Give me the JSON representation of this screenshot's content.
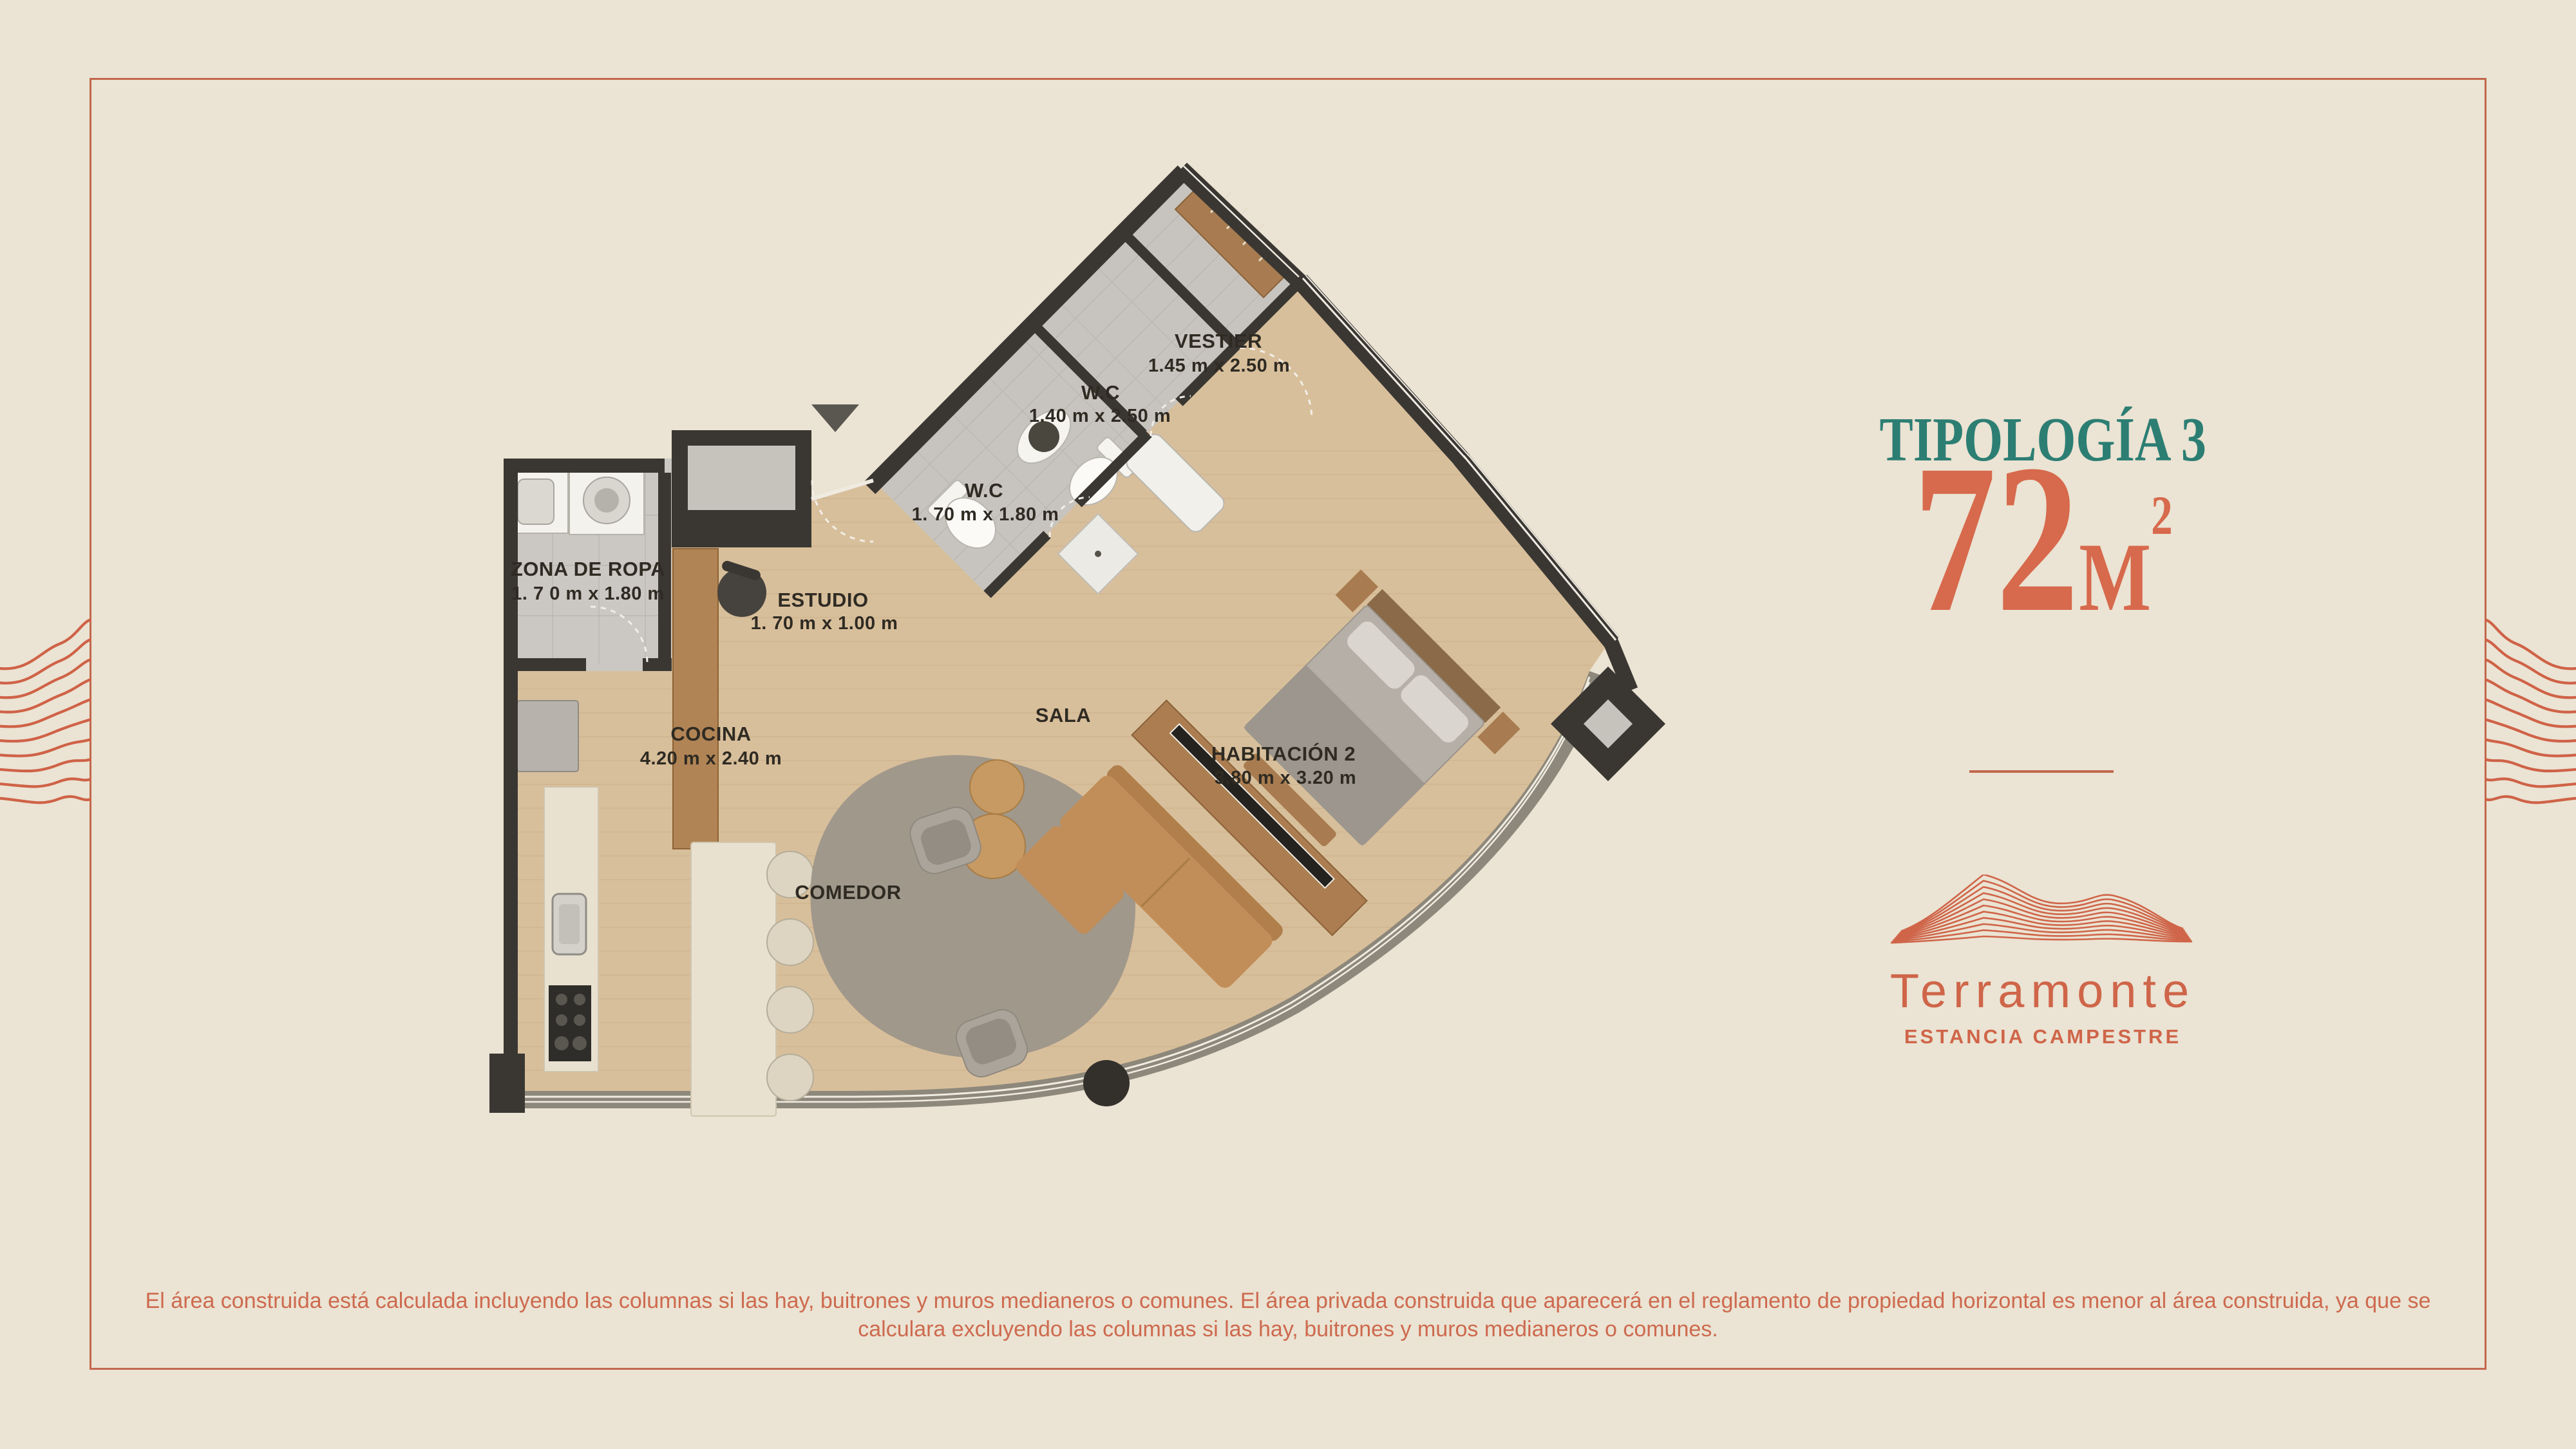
{
  "page": {
    "background": "#ebe3d3",
    "frame_color": "#c2684e",
    "accent_orange": "#d7694c",
    "accent_teal": "#2c7e73",
    "wall_color": "#3a3733"
  },
  "panel": {
    "title": "TIPOLOGÍA 3",
    "area_number": "72",
    "area_unit": "M",
    "area_superscript": "2"
  },
  "brand": {
    "wordmark": "Terramonte",
    "tagline": "ESTANCIA CAMPESTRE"
  },
  "floor_plan": {
    "rooms": {
      "zona": {
        "name": "ZONA DE ROPA",
        "dims": "1. 7 0 m x 1.80 m"
      },
      "estudio": {
        "name": "ESTUDIO",
        "dims": "1. 70 m x  1.00 m"
      },
      "wc1": {
        "name": "W.C",
        "dims": "1. 70 m x 1.80 m"
      },
      "wc2": {
        "name": "W.C",
        "dims": "1.40 m x 2.50 m"
      },
      "vestier": {
        "name": "VESTIER",
        "dims": "1.45 m x 2.50 m"
      },
      "cocina": {
        "name": "COCINA",
        "dims": "4.20 m x  2.40 m"
      },
      "comedor": {
        "name": "COMEDOR"
      },
      "sala": {
        "name": "SALA"
      },
      "habitacion2": {
        "name": "HABITACIÓN 2",
        "dims": "3.80 m x 3.20 m"
      }
    }
  },
  "disclaimer": {
    "line1": "El área construida está calculada incluyendo las columnas si las hay, buitrones y muros medianeros o comunes. El área privada construida que aparecerá en el reglamento de propiedad horizontal es menor al área construida, ya que se",
    "line2": "calculara excluyendo las columnas si las hay, buitrones y muros medianeros o comunes."
  }
}
